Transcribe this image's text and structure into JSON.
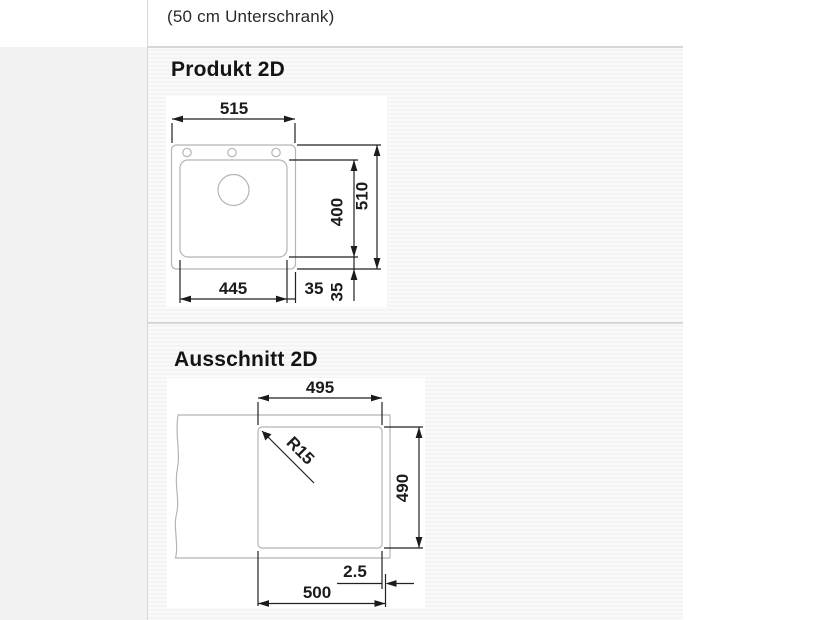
{
  "page": {
    "subtitle": "(50 cm Unterschrank)"
  },
  "sections": {
    "produkt": {
      "title": "Produkt 2D",
      "dims": {
        "total_width": "515",
        "basin_depth": "400",
        "total_depth": "510",
        "basin_width": "445",
        "right_offset": "35",
        "bottom_offset": "35"
      }
    },
    "ausschnitt": {
      "title": "Ausschnitt 2D",
      "dims": {
        "cutout_width": "495",
        "corner_radius": "R15",
        "cutout_depth": "490",
        "edge_gap": "2.5",
        "overall_width": "500"
      }
    }
  },
  "colors": {
    "outline_grey": "#b5b5b5",
    "dimension_black": "#1b1b1b",
    "separator_grey": "#d8d8d8",
    "page_stripe_bg": "#fafafa"
  }
}
